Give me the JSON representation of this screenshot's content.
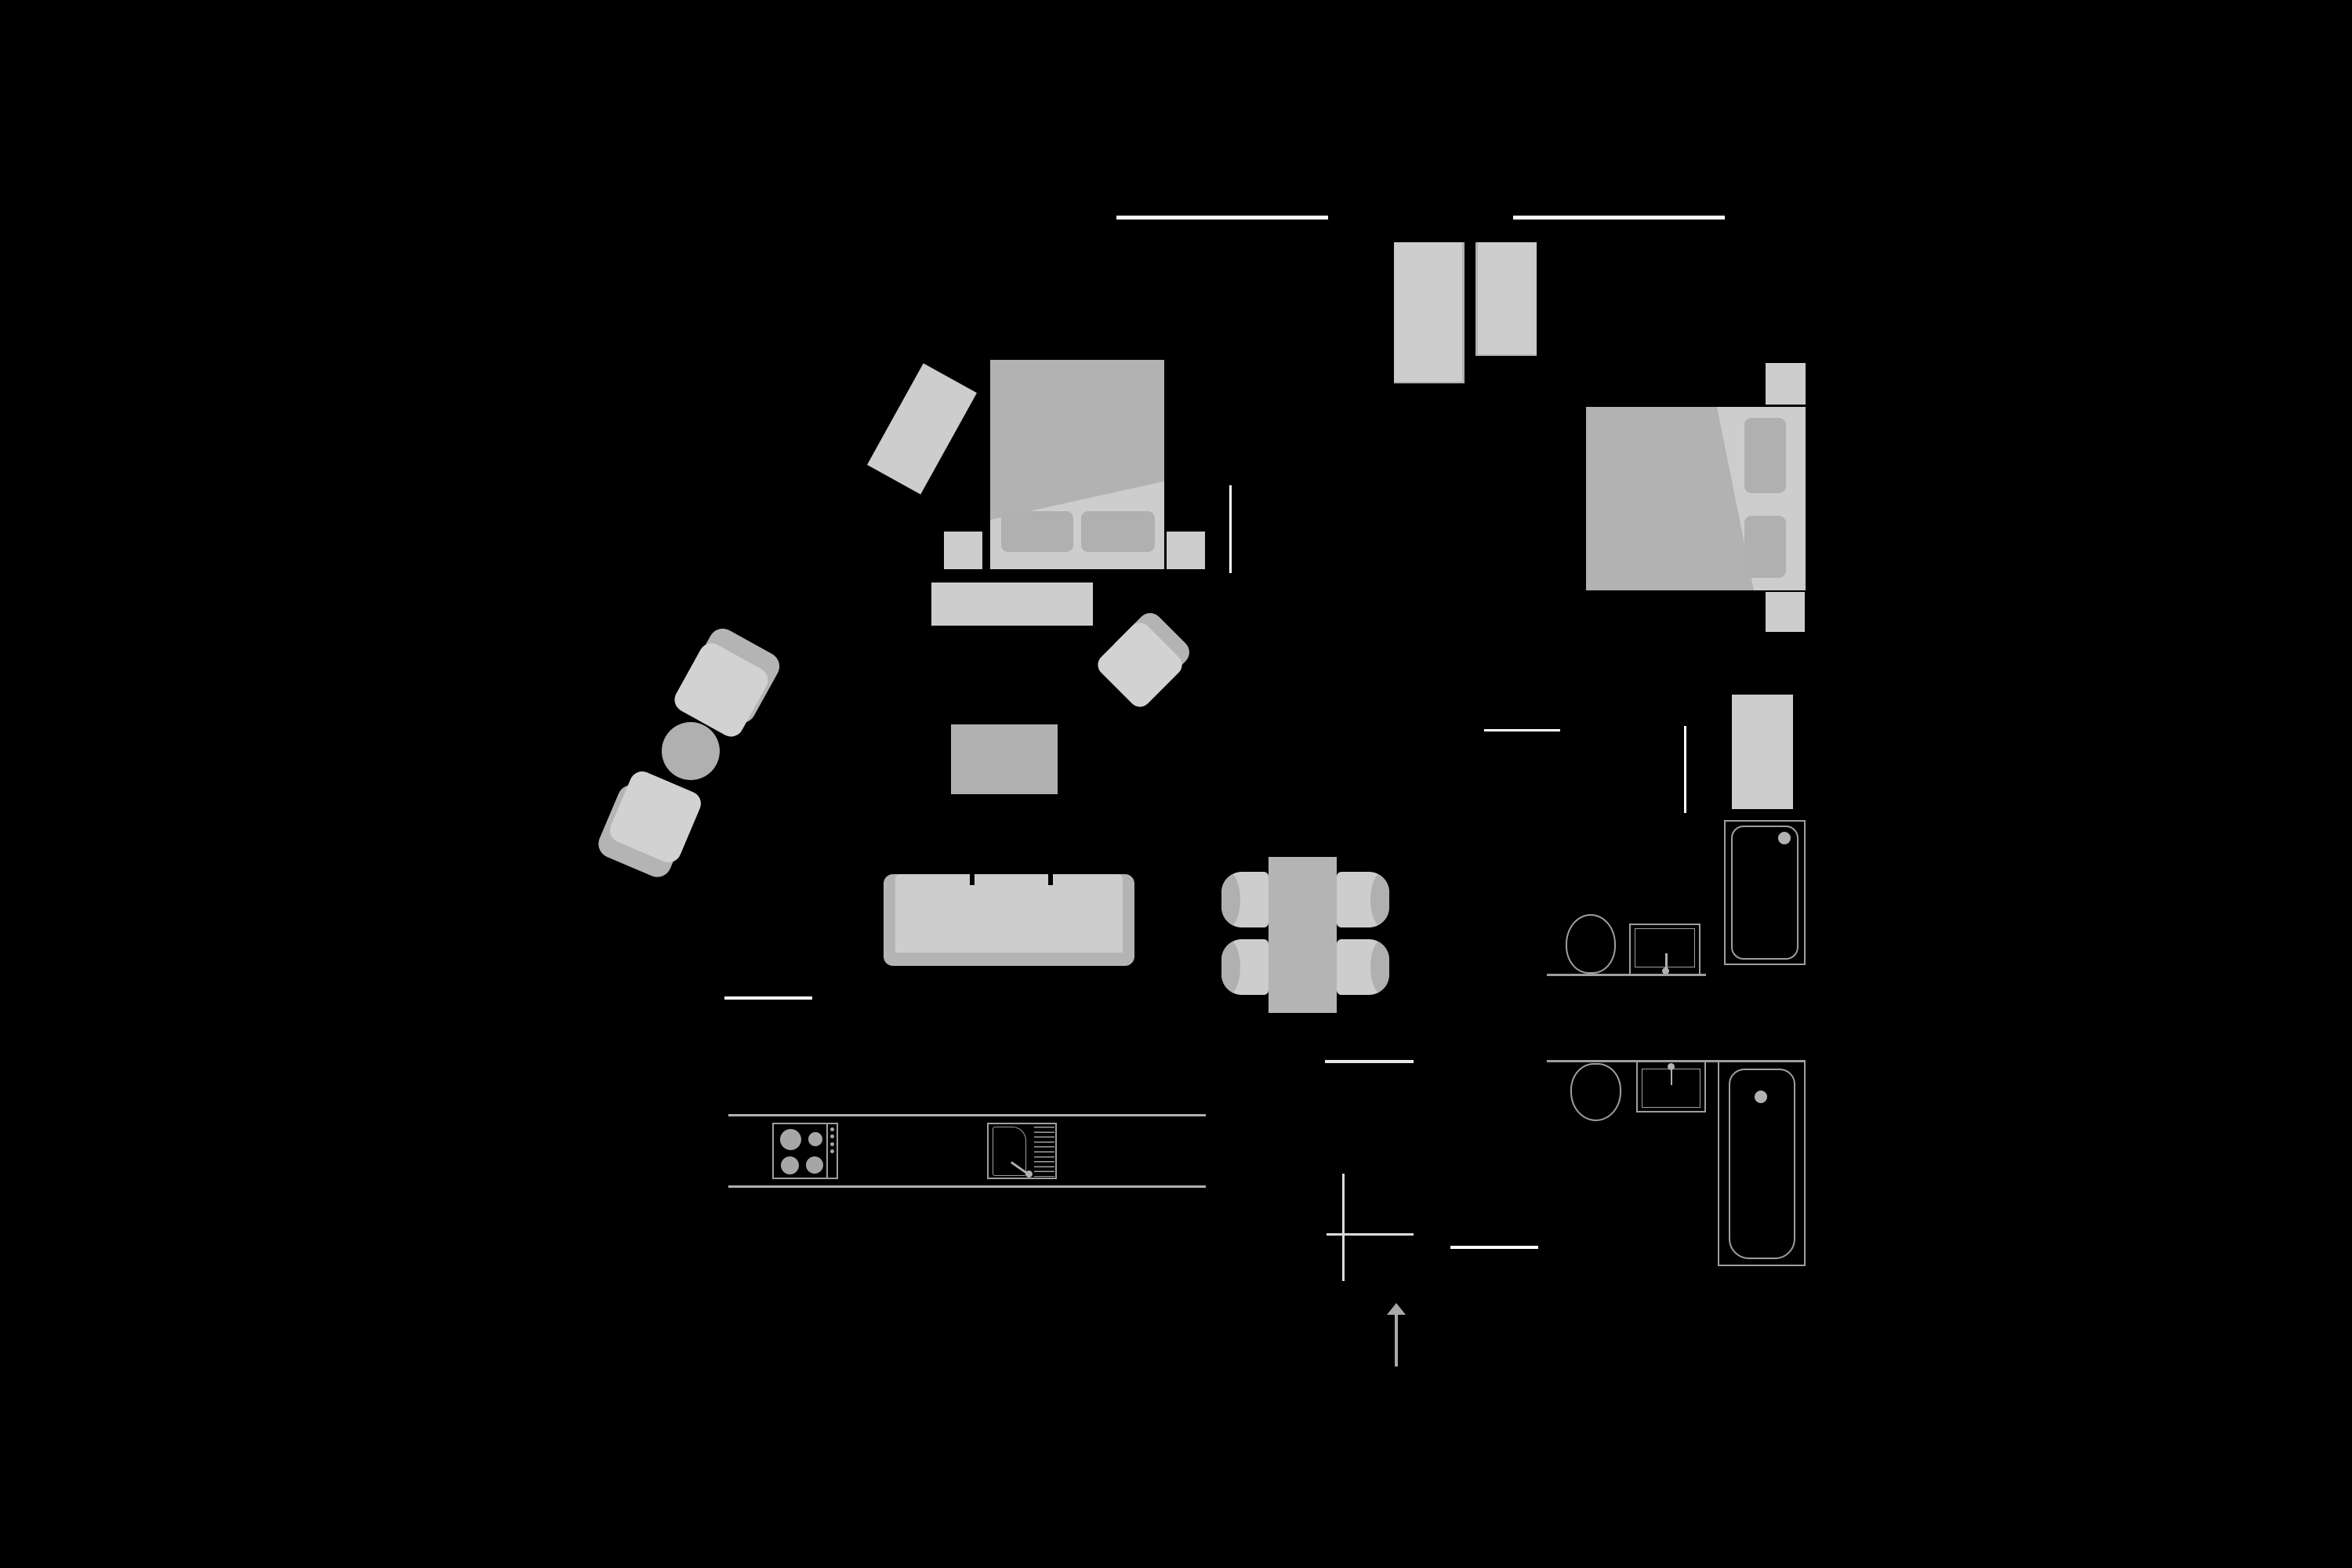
{
  "title": "apartment-floor-plan",
  "colors": {
    "bg": "#000000",
    "light_furniture": "#cdcdcd",
    "seat_light": "#d2d2d2",
    "medium_gray": "#b2b2b2",
    "frame_gray": "#b4b4b4",
    "pillow_gray": "#b0b0b0",
    "fixture_stroke": "#9e9e9e",
    "wall_white": "#ffffff",
    "symbol_gray": "#a9a9a9",
    "cross_gray": "#dcdcdc",
    "counter_gray": "#b0b0b0"
  },
  "rooms": {
    "bedroom_left": {
      "name": "bedroom-1",
      "furniture": [
        "double-bed-with-duvet",
        "pillow",
        "pillow",
        "nightstand",
        "nightstand",
        "rotated-rug",
        "dresser",
        "rotated-armchair"
      ]
    },
    "bedroom_right": {
      "name": "bedroom-2",
      "furniture": [
        "double-bed-with-duvet",
        "pillow",
        "pillow",
        "nightstand",
        "nightstand",
        "wardrobe-tall",
        "wardrobe-short"
      ]
    },
    "living_room": {
      "name": "living-room",
      "furniture": [
        "armchair",
        "armchair",
        "round-side-table",
        "coffee-table",
        "three-seat-sofa"
      ]
    },
    "dining_area": {
      "name": "dining-area",
      "furniture": [
        "dining-table",
        "chair",
        "chair",
        "chair",
        "chair"
      ]
    },
    "kitchen": {
      "name": "kitchen",
      "appliances": [
        "cooktop-4-burners-with-knobs",
        "sink-with-drainboard-and-faucet"
      ],
      "counter_lines": 2
    },
    "bathroom_top": {
      "name": "bathroom-1",
      "fixtures": [
        "toilet",
        "washbasin-with-faucet",
        "shower-cabin-with-head",
        "washing-machine"
      ]
    },
    "bathroom_bottom": {
      "name": "bathroom-2",
      "fixtures": [
        "toilet",
        "washbasin-with-faucet",
        "bathtub-with-faucet"
      ]
    },
    "openings": [
      "window-top-left",
      "window-top-right",
      "kitchen-wall-opening",
      "dining-wall-opening",
      "bathroom2-wall-opening",
      "bedroom1-side-opening",
      "bedroom2-side-opening",
      "bathroom1-door-line"
    ],
    "symbols": [
      "origin-cross-marker",
      "entrance-arrow-up"
    ]
  }
}
